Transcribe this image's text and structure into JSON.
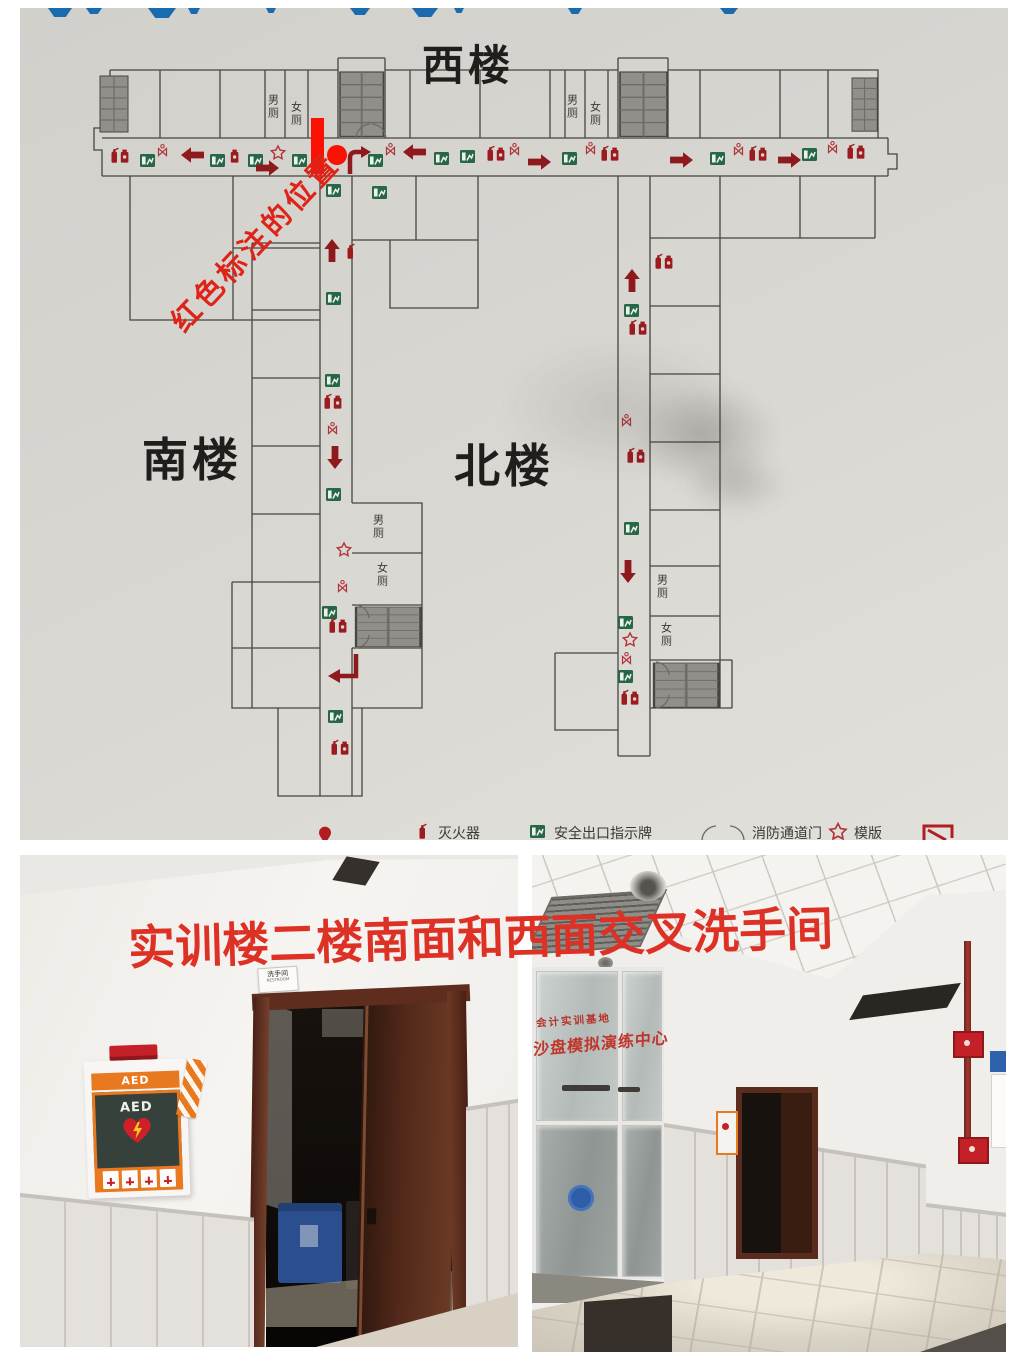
{
  "floor_plan_photo": {
    "title": "西楼",
    "south_building_label": "南楼",
    "north_building_label": "北楼",
    "annotation": {
      "text": "红色标注的位置",
      "color": "#e02318"
    },
    "toilet_labels": {
      "mens": "男厕",
      "womens": "女厕"
    },
    "legend": {
      "items": [
        {
          "icon": "fire-extinguisher-icon",
          "label": "灭火器"
        },
        {
          "icon": "exit-sign-icon",
          "label": "安全出口指示牌"
        },
        {
          "icon": "fire-door-icon",
          "label": "消防通道门"
        },
        {
          "icon": "star-icon",
          "label": "模版"
        }
      ]
    },
    "colors": {
      "exit_sign_green": "#266747",
      "safety_icon_red": "#9c1b1f",
      "arrow_red": "#8f1a1e",
      "marker_red": "#fb1104",
      "stairs_gray": "#918f8a"
    }
  },
  "left_photo": {
    "restroom_sign": {
      "line1": "洗手间",
      "line2": "RESTROOM"
    },
    "aed_cabinet": {
      "header": "AED",
      "device_label": "AED",
      "accent_orange": "#e8791f"
    }
  },
  "right_photo": {
    "glass_sign": {
      "line1": "会计实训基地",
      "line2": "沙盘模拟演练中心",
      "color": "#bf362c"
    }
  },
  "caption": {
    "text": "实训楼二楼南面和西面交叉洗手间",
    "color": "#de3125"
  }
}
